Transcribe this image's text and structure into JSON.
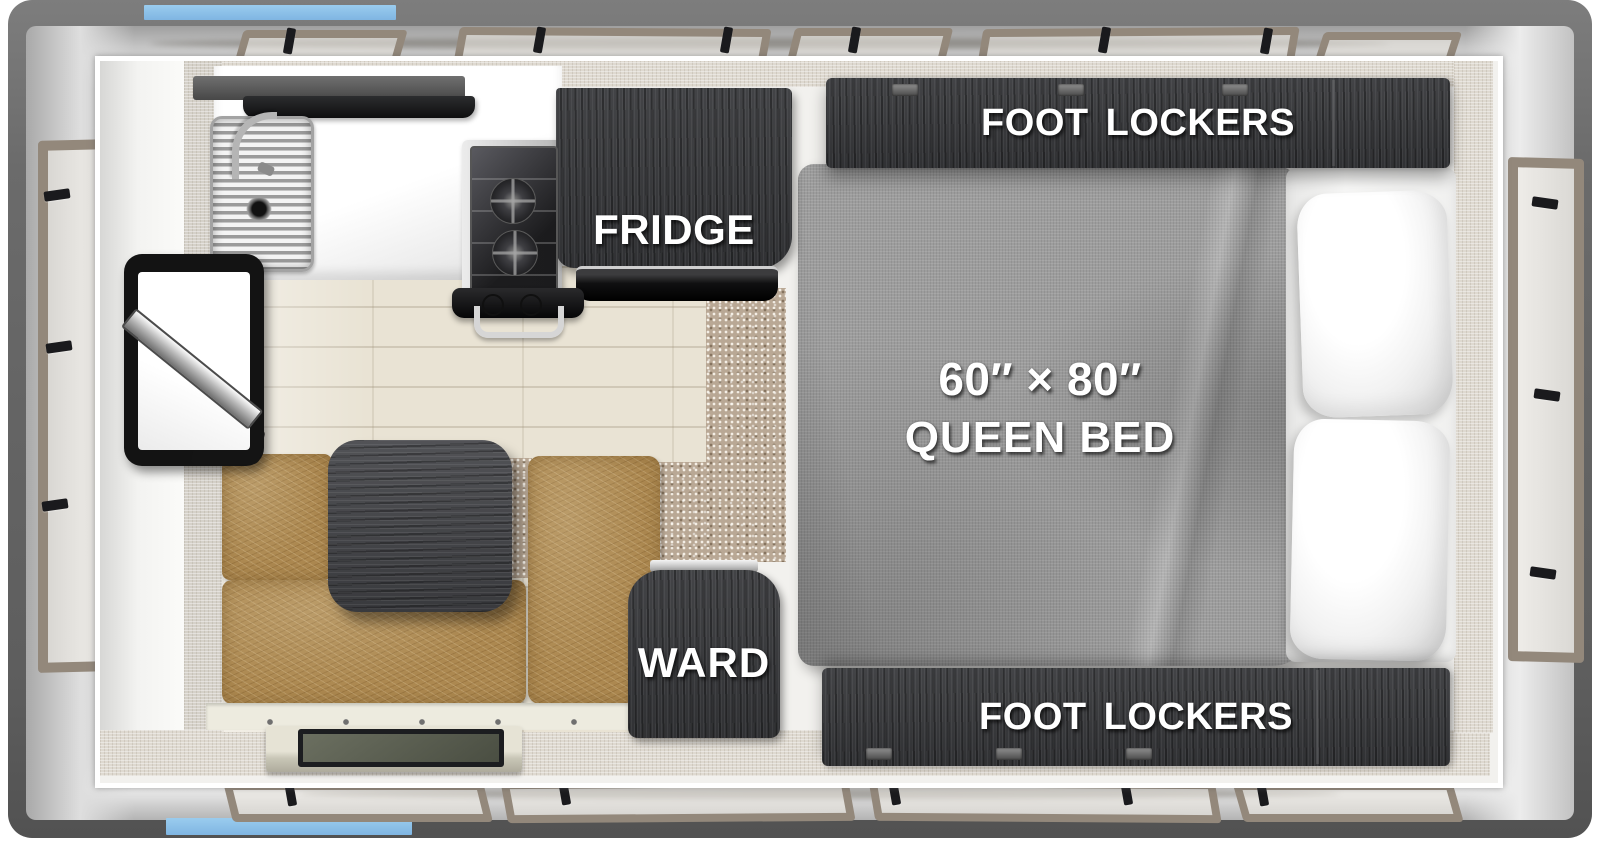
{
  "floorplan": {
    "title": "Truck camper floor plan (top view)",
    "labels": {
      "fridge": "FRIDGE",
      "foot_lockers_top": "FOOT LOCKERS",
      "foot_lockers_bottom": "FOOT LOCKERS",
      "wardrobe": "WARD",
      "bed_size": "60″ × 80″",
      "bed_name": "QUEEN BED"
    },
    "colors": {
      "accent_blue": "#7FB5E2",
      "frame_gray": "#6A6A6A",
      "cabinet_dark": "#37383B",
      "upholstery_tan": "#AC8850",
      "bed_fabric_gray": "#9D9D9D",
      "window_trim_taupe": "#93887B",
      "carpet_tan": "#B9A895",
      "wood_floor": "#E9E3D4"
    },
    "features": [
      "kitchen sink with cover",
      "faucet",
      "range hood shelf",
      "two-burner cooktop",
      "refrigerator cabinet",
      "tv on swing arm",
      "dinette bench seats",
      "dinette pedestal table",
      "entry step",
      "wardrobe cabinet",
      "queen bed",
      "four pillows",
      "foot locker cabinets",
      "side and end windows",
      "blue awning markers"
    ]
  }
}
